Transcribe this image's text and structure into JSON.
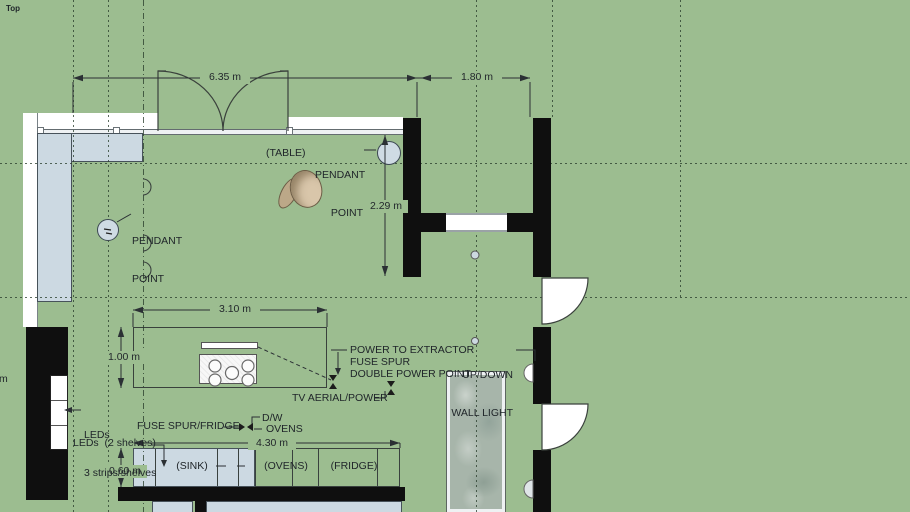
{
  "view": {
    "label": "Top"
  },
  "colors": {
    "background": "#9cbd90",
    "counter": "#ccd9e2",
    "wall": "#0f0f0f",
    "glass": "#a7b5aa",
    "chair": "#d9c6aa",
    "annotation_text": "#20262a"
  },
  "dimensions": {
    "top_span": "6.35 m",
    "opening": "1.80 m",
    "table_clearance": "2.29 m",
    "island_length": "3.10 m",
    "island_width": "1.00 m",
    "counter_depth": "0.60 m",
    "counter_run": "4.30 m",
    "left_edge_partial": "m"
  },
  "annotations": {
    "table": "(TABLE)",
    "pendant_point_table": [
      "PENDANT",
      "POINT"
    ],
    "pendant_point_left": [
      "PENDANT",
      "POINT"
    ],
    "power_to_extractor": "POWER TO EXTRACTOR",
    "fuse_spur": "FUSE SPUR",
    "double_power_point": "DOUBLE POWER POINT",
    "tv_aerial_power": "TV AERIAL/POWER",
    "up_down_wall_light": [
      "UP/DOWN",
      "WALL LIGHT"
    ],
    "leds_shelves": [
      "LEDs",
      "3 strips/shelves"
    ],
    "fuse_spur_fridge": "FUSE SPUR/FRIDGE",
    "leds_2_shelves": "LEDs  (2 shelves)",
    "dishwasher": "D/W",
    "ovens_power": "OVENS",
    "sink_unit": "(SINK)",
    "ovens_unit": "(OVENS)",
    "fridge_unit": "(FRIDGE)"
  }
}
